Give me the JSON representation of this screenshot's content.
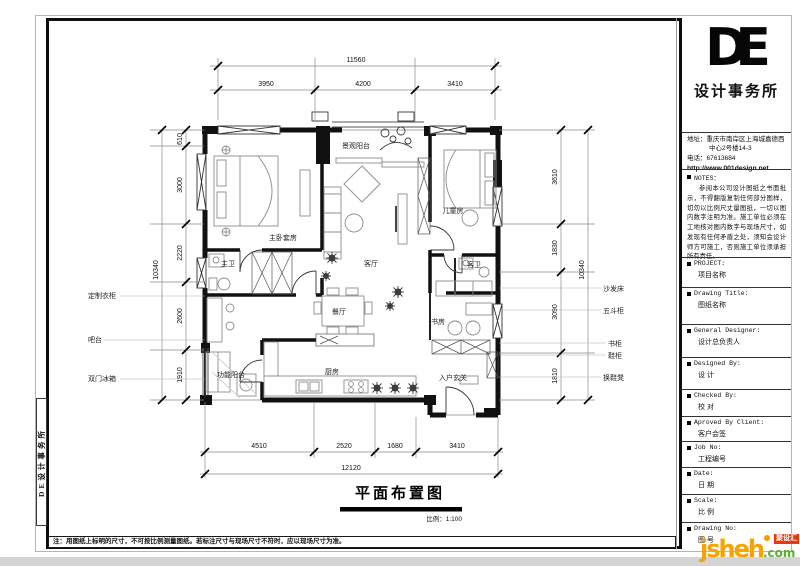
{
  "page": {
    "sheet_note": "注：用图纸上标明的尺寸，不可按比例测量图纸。若标注尺寸与现场尺寸不符时，应以现场尺寸为准。",
    "side_strip_text": "DE设计事务所"
  },
  "title_block": {
    "logo_text": "DE",
    "firm_name": "设计事务所",
    "address_line1": "地址：重庆市南岸区上海城嘉德西",
    "address_line2": "中心2号楼14-3",
    "phone": "电话：67613684",
    "website": "http://www.001design.net",
    "notes_heading": "NOTES：",
    "notes_body": "参阅本公司设计图纸之书面批示，不得翻版复制任何部分图样，切勿以比例尺丈量图纸，一切以图内数字注明为准。施工单位必须在工地核对图内数字与现场尺寸，如发现有任何矛盾之处，须知会设计师方可施工，否则施工单位须承担所有责任。",
    "fields": [
      {
        "label": "PROJECT:",
        "value": "项目名称"
      },
      {
        "label": "Drawing Title:",
        "value": "图纸名称"
      },
      {
        "label": "General Designer:",
        "value": "设计总负责人"
      },
      {
        "label": "Designed By:",
        "value": "设 计"
      },
      {
        "label": "Checked By:",
        "value": "校 对"
      },
      {
        "label": "Aproved By Client:",
        "value": "客户会签"
      },
      {
        "label": "Job No:",
        "value": "工程编号"
      },
      {
        "label": "Date:",
        "value": "日 期"
      },
      {
        "label": "Scale:",
        "value": "比 例"
      },
      {
        "label": "Drawing No:",
        "value": "图 号"
      }
    ]
  },
  "floor_plan": {
    "title": "平面布置图",
    "scale": "比例：1:100",
    "rooms": [
      "景观阳台",
      "主卧套房",
      "儿童房",
      "客厅",
      "主卫",
      "客卫",
      "餐厅",
      "书房",
      "功能阳台",
      "厨房",
      "入户玄关"
    ],
    "annotations": {
      "left": [
        "定制衣柜",
        "吧台",
        "双门冰箱"
      ],
      "right": [
        "沙发床",
        "五斗柜",
        "书柜",
        "鞋柜",
        "换鞋凳"
      ]
    },
    "dimensions": {
      "top_overall": "11560",
      "top_segments": [
        "3950",
        "4200",
        "3410"
      ],
      "left_overall": "10340",
      "left_segments": [
        "610",
        "3000",
        "2220",
        "2600",
        "1910"
      ],
      "right_overall": "10340",
      "right_segments": [
        "3610",
        "1830",
        "3090",
        "1810"
      ],
      "bottom_overall": "12120",
      "bottom_segments": [
        "4510",
        "2520",
        "1680",
        "3410"
      ]
    }
  },
  "watermark": {
    "name": "jsheh",
    "tld": ".com",
    "badge": "聚设汇"
  }
}
